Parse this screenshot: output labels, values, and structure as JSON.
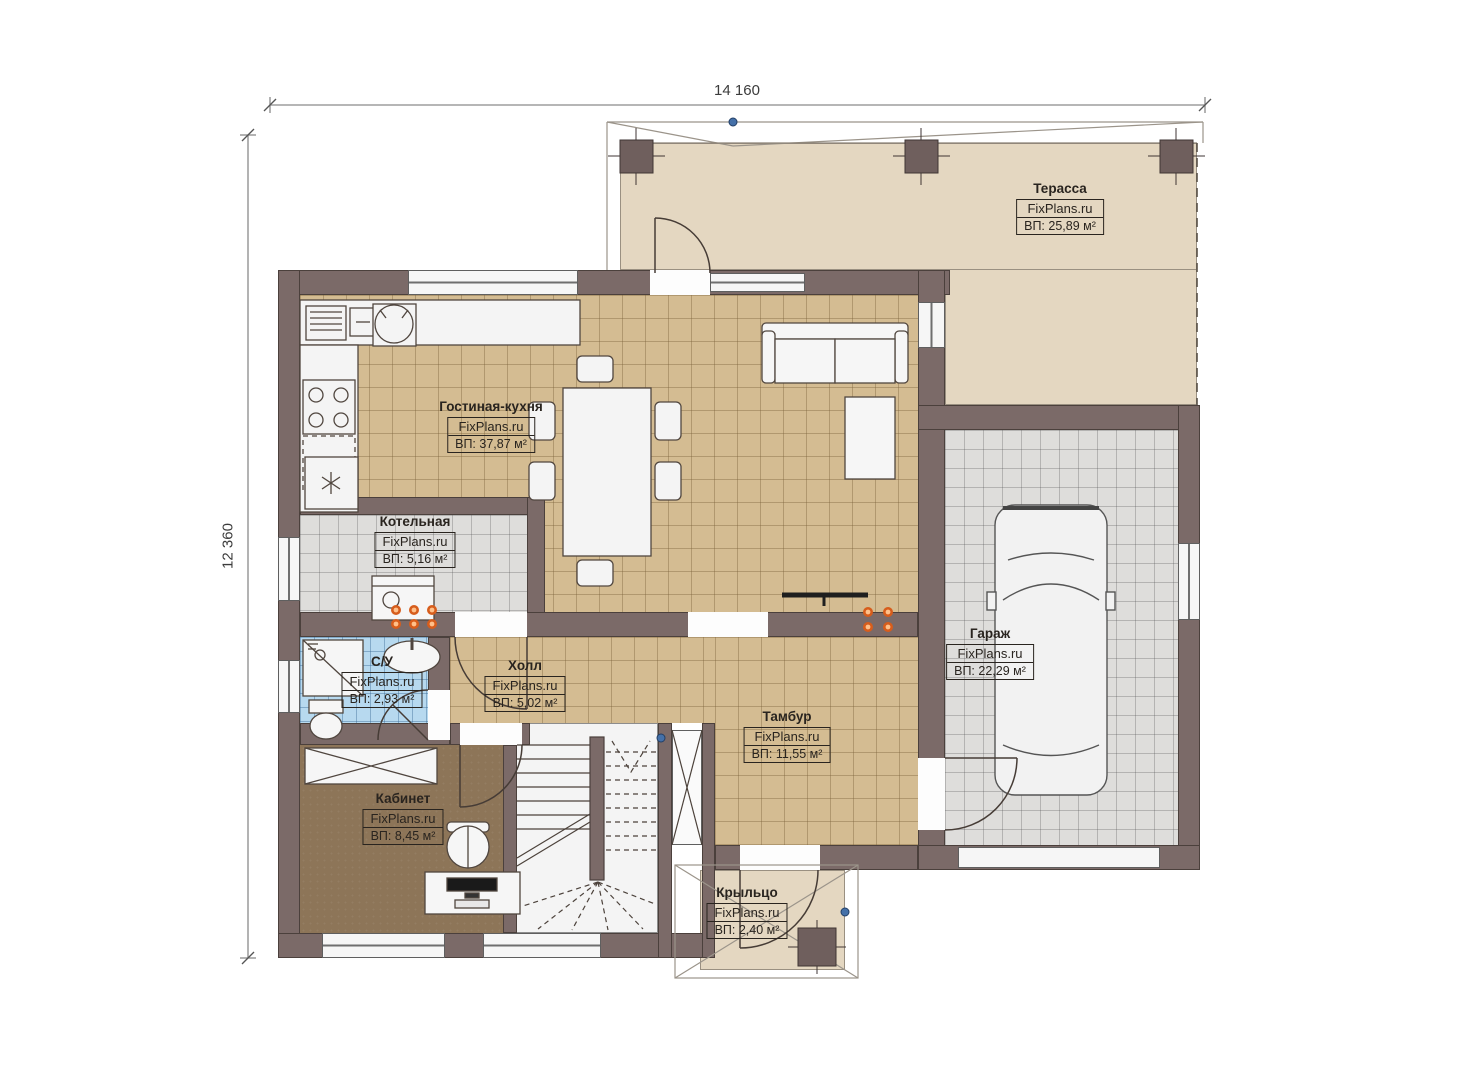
{
  "plan": {
    "brand": "FixPlans.ru",
    "dimensions": {
      "width_mm": "14 160",
      "height_mm": "12 360"
    },
    "rooms": [
      {
        "id": "terrace",
        "name": "Терасса",
        "brand": "FixPlans.ru",
        "area_label": "ВП: 25,89 м²"
      },
      {
        "id": "living-kitchen",
        "name": "Гостиная-кухня",
        "brand": "FixPlans.ru",
        "area_label": "ВП: 37,87 м²"
      },
      {
        "id": "boiler-room",
        "name": "Котельная",
        "brand": "FixPlans.ru",
        "area_label": "ВП: 5,16 м²"
      },
      {
        "id": "bathroom",
        "name": "С/У",
        "brand": "FixPlans.ru",
        "area_label": "ВП: 2,93 м²"
      },
      {
        "id": "hall",
        "name": "Холл",
        "brand": "FixPlans.ru",
        "area_label": "ВП: 5,02 м²"
      },
      {
        "id": "vestibule",
        "name": "Тамбур",
        "brand": "FixPlans.ru",
        "area_label": "ВП: 11,55 м²"
      },
      {
        "id": "garage",
        "name": "Гараж",
        "brand": "FixPlans.ru",
        "area_label": "ВП: 22,29 м²"
      },
      {
        "id": "office",
        "name": "Кабинет",
        "brand": "FixPlans.ru",
        "area_label": "ВП: 8,45 м²"
      },
      {
        "id": "porch",
        "name": "Крыльцо",
        "brand": "FixPlans.ru",
        "area_label": "ВП: 2,40 м²"
      }
    ],
    "palette": {
      "wall": "#7b6a68",
      "terrace_floor": "#e4d7c1",
      "tile_tan": "#d4bc92",
      "tile_gray": "#dedddb",
      "tile_blue": "#b7d9ef",
      "office_floor": "#8d7558",
      "radiator_orange": "#e8762a",
      "marker_blue": "#4470a8"
    }
  }
}
